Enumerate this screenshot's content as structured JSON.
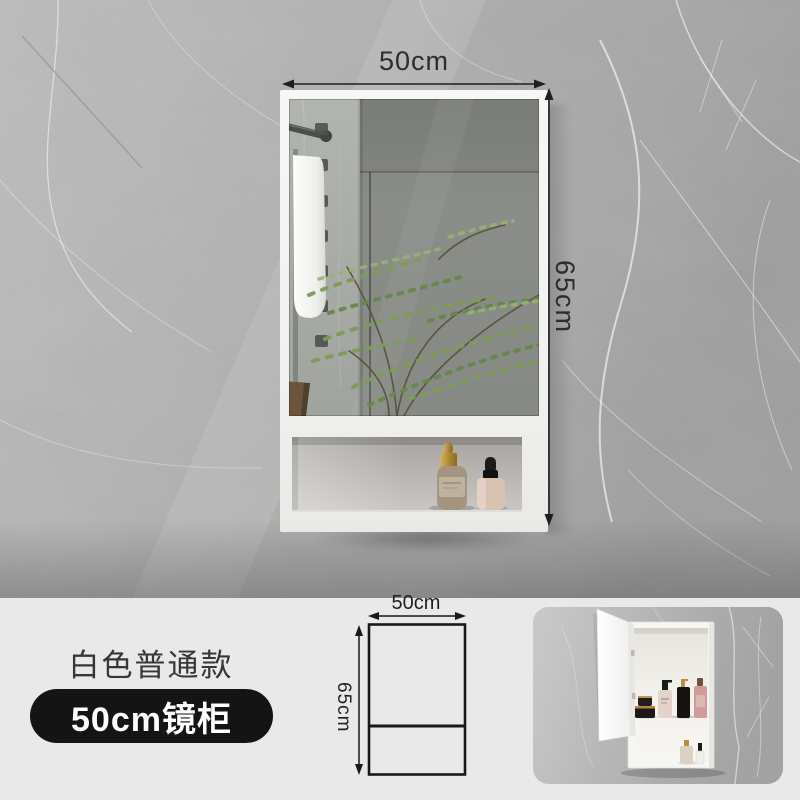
{
  "main_photo": {
    "width_label": "50cm",
    "height_label": "65cm"
  },
  "info_panel": {
    "variant_name": "白色普通款",
    "badge_label": "50cm镜柜"
  },
  "size_diagram": {
    "width_label": "50cm",
    "height_label": "65cm"
  },
  "colors": {
    "panel_bg": "#e9e9e9",
    "badge_bg": "#141414",
    "badge_text": "#ffffff",
    "annotation_text": "#2d2d2d",
    "cabinet_white": "#f4f4f2",
    "wall_gray": "#b0b0b0",
    "mirror_gray": "#8a8d88",
    "plant_green": "#76974f"
  }
}
